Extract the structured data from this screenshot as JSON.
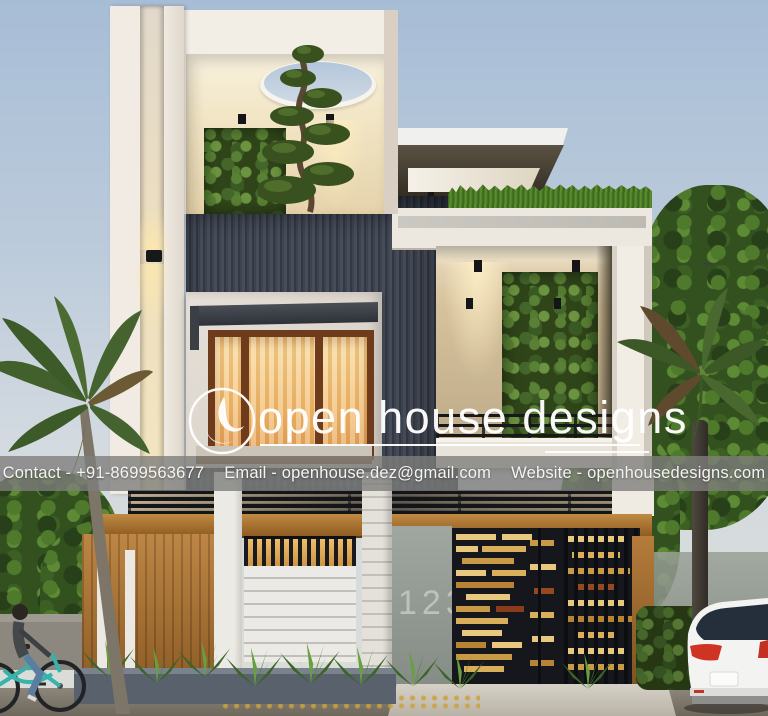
{
  "image_type": "3d-architectural-exterior-render-of-modern-duplex-house",
  "watermark": {
    "brand_name": "open house designs",
    "logo_icon": "open-house-designs-logo-circle"
  },
  "contact_bar": {
    "contact": "Contact - +91-8699563677",
    "email": "Email - openhouse.dez@gmail.com",
    "website": "Website - openhousedesigns.com"
  },
  "house": {
    "number_plate": "123"
  },
  "colors": {
    "sky_top": "#a7bdd6",
    "sky_bottom": "#dcdcd6",
    "facade_white": "#f2ede5",
    "facade_dark_slat": "#3c4250",
    "wood": "#b07a3c",
    "warm_window_light": "#f2bc6f",
    "greenery": "#4a6b2d",
    "gate_gold": "#e2bb6e",
    "gate_dark": "#15171c",
    "contact_bar_bg": "#7e7e7c",
    "watermark_white": "#ffffff",
    "bicycle_teal": "#35b3ac",
    "car_white": "#f3f3f1"
  },
  "scene_objects": [
    "circular-skylight-with-bonsai-tree",
    "vertical-garden-walls",
    "wall-sconce-light",
    "lit-three-pane-window",
    "grass-roof-edge",
    "open-balcony-with-railing",
    "gold-slat-decorative-gate",
    "house-number-wall",
    "wooden-fence-panel",
    "agave-shrubs",
    "left-palm-tree",
    "right-palm-tree",
    "background-trees",
    "cyclist-on-teal-bicycle",
    "white-suv-car",
    "driveway",
    "bird-in-sky"
  ]
}
